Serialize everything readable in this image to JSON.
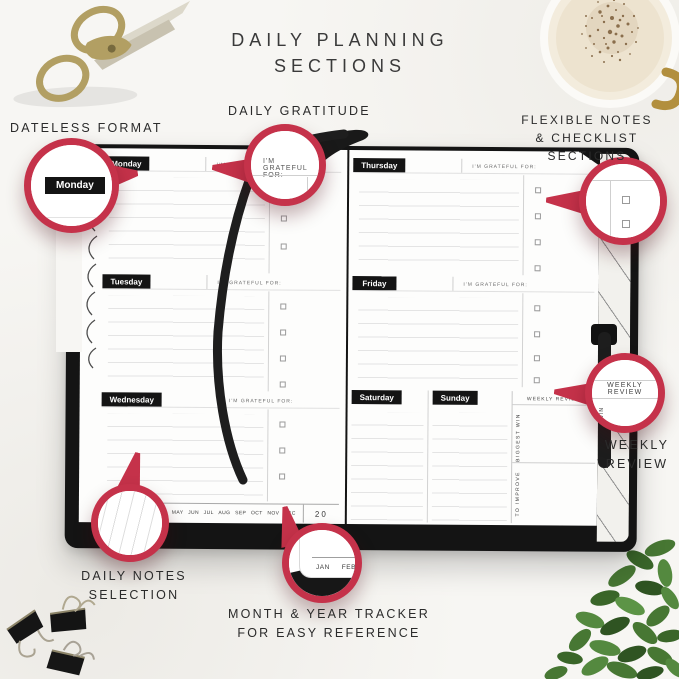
{
  "title": {
    "line1": "DAILY PLANNING",
    "line2": "SECTIONS"
  },
  "callouts": {
    "dateless_format": "DATELESS FORMAT",
    "daily_gratitude": "DAILY GRATITUDE",
    "flexible_notes_line1": "FLEXIBLE NOTES",
    "flexible_notes_line2": "& CHECKLIST SECTIONS",
    "weekly_review_line1": "WEEKLY",
    "weekly_review_line2": "REVIEW",
    "daily_notes_line1": "DAILY NOTES",
    "daily_notes_line2": "SELECTION",
    "month_tracker_line1": "MONTH & YEAR TRACKER",
    "month_tracker_line2": "FOR EASY REFERENCE"
  },
  "planner": {
    "days": [
      "Monday",
      "Tuesday",
      "Wednesday",
      "Thursday",
      "Friday",
      "Saturday",
      "Sunday"
    ],
    "gratitude_label": "I'M GRATEFUL FOR:",
    "weekly_review_header": "WEEKLY REVIEW",
    "biggest_win_label": "BIGGEST WIN",
    "to_improve_label": "TO IMPROVE",
    "months": [
      "JAN",
      "FEB",
      "MAR",
      "APR",
      "MAY",
      "JUN",
      "JUL",
      "AUG",
      "SEP",
      "OCT",
      "NOV",
      "DEC"
    ],
    "year_prefix": "20"
  },
  "magnifiers": {
    "win_partial": "WIN"
  },
  "colors": {
    "accent_red": "#c5324a",
    "ink_black": "#141414"
  }
}
